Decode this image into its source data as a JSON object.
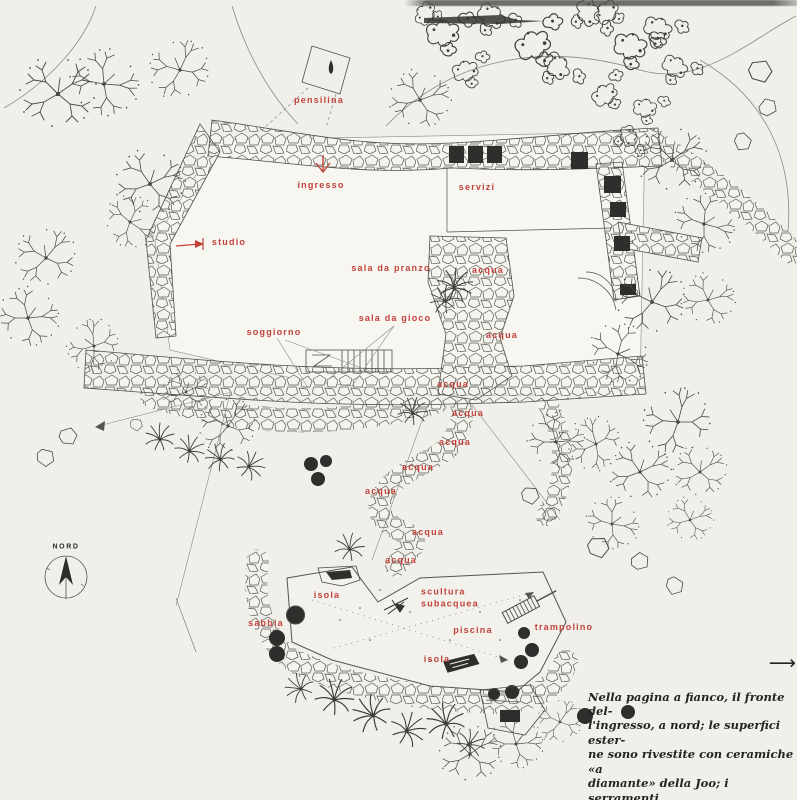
{
  "page": {
    "paper_color": "#f0efe9",
    "ink_color": "#45453f",
    "label_color": "#c2423c"
  },
  "plan": {
    "labels": [
      {
        "id": "pensilina",
        "text": "pensilina"
      },
      {
        "id": "ingresso",
        "text": "ingresso"
      },
      {
        "id": "servizi",
        "text": "servizi"
      },
      {
        "id": "studio",
        "text": "studio"
      },
      {
        "id": "sala-da-pranzo",
        "text": "sala da pranzo"
      },
      {
        "id": "sala-da-gioco",
        "text": "sala da gioco"
      },
      {
        "id": "soggiorno",
        "text": "soggiorno"
      },
      {
        "id": "acqua-1",
        "text": "acqua"
      },
      {
        "id": "acqua-2",
        "text": "acqua"
      },
      {
        "id": "acqua-3",
        "text": "acqua"
      },
      {
        "id": "acqua-4",
        "text": "acqua"
      },
      {
        "id": "acqua-5",
        "text": "acqua"
      },
      {
        "id": "acqua-6",
        "text": "acqua"
      },
      {
        "id": "acqua-7",
        "text": "acqua"
      },
      {
        "id": "acqua-8",
        "text": "acqua"
      },
      {
        "id": "acqua-9",
        "text": "acqua"
      },
      {
        "id": "isola-1",
        "text": "isola"
      },
      {
        "id": "scultura-subacquea",
        "text": "scultura\nsubacquea"
      },
      {
        "id": "sabbia",
        "text": "sabbia"
      },
      {
        "id": "piscina",
        "text": "piscina"
      },
      {
        "id": "isola-2",
        "text": "isola"
      },
      {
        "id": "trampolino",
        "text": "trampolino"
      }
    ],
    "compass": {
      "label": "NORD"
    }
  },
  "caption": {
    "text": "Nella pagina a fianco, il fronte del-\nl'ingresso, a nord; le superfici ester-\nne sono rivestite con ceramiche «a\ndiamante» della Joo; i serramenti\nsono in alluminio, della Malugani.",
    "arrow": "⟶"
  }
}
